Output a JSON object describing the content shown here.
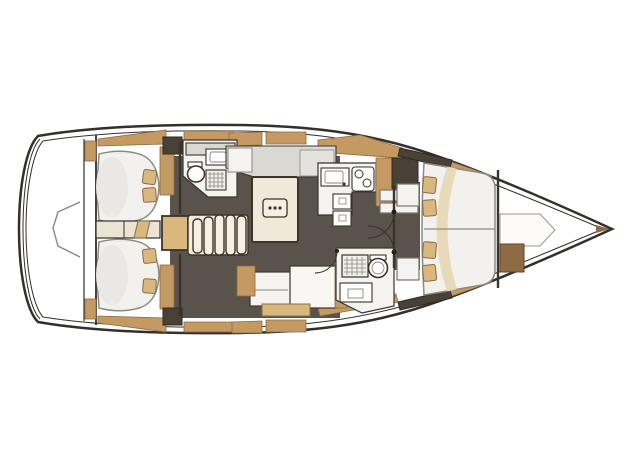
{
  "page": {
    "background": "#ffffff"
  },
  "colors": {
    "background": "#ffffff",
    "hull_line": "#33302b",
    "deck": "#e9e1cd",
    "sole": "#5a534b",
    "wall": "#3a342c",
    "wood": "#c49a62",
    "wood_light": "#d9b87d",
    "wood_deep": "#8d6b45",
    "wood_dark": "#4a4136",
    "furniture": "#f4f3ef",
    "counter": "#d9d8d3",
    "mattress": "#f2f1ee",
    "mattress_line": "#8b8a85",
    "table": "#efe9da",
    "stair": "#f4ecd9",
    "crescent": "#e8d9b8"
  },
  "drawing": {
    "type": "yacht-interior-deck-plan",
    "orientation": "bow-right",
    "areas": [
      "swim-platform",
      "aft-cabin-starboard",
      "aft-cabin-port",
      "companionway-stairs",
      "aft-head",
      "saloon",
      "saloon-table",
      "galley",
      "forward-head",
      "forward-cabin",
      "bow-stowage"
    ]
  }
}
